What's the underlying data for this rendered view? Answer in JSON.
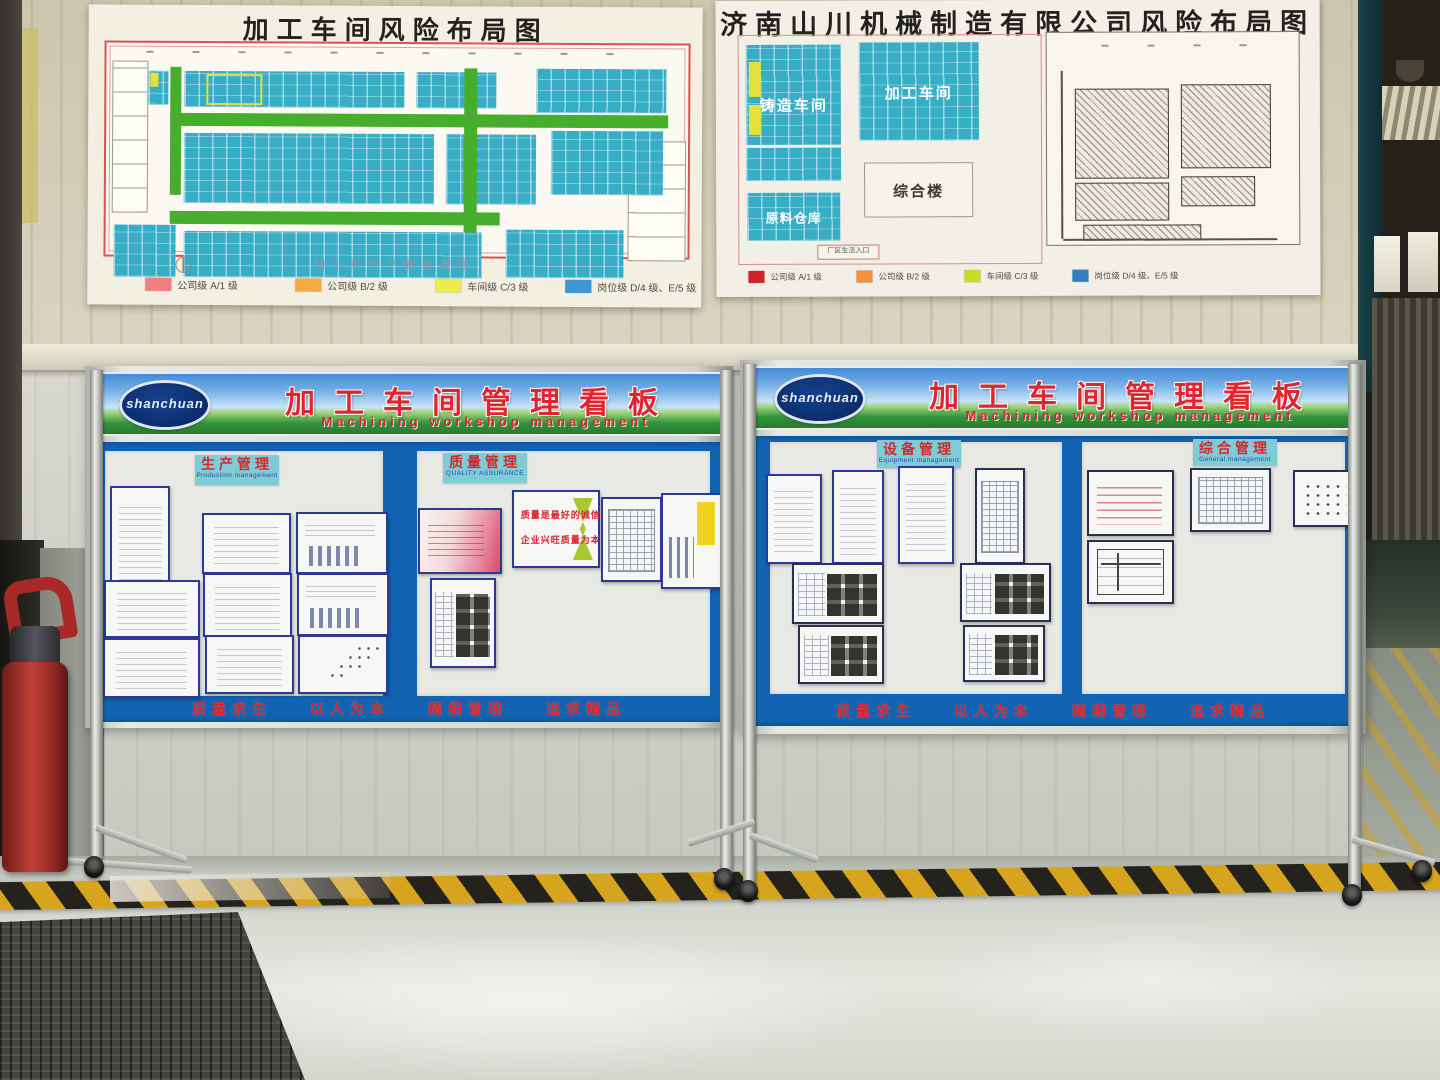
{
  "posters": {
    "left": {
      "title": "加工车间风险布局图",
      "caption": "加工车间平面布置图",
      "legend": [
        {
          "color": "#f08080",
          "label": "公司级  A/1 级"
        },
        {
          "color": "#f5a93f",
          "label": "公司级  B/2 级"
        },
        {
          "color": "#efed4d",
          "label": "车间级  C/3 级"
        },
        {
          "color": "#3f96d2",
          "label": "岗位级  D/4 级、E/5 级"
        }
      ]
    },
    "right": {
      "title": "济南山川机械制造有限公司风险布局图",
      "blocks": {
        "casting": "铸造车间",
        "machining": "加工车间",
        "office": "综合楼",
        "warehouse": "原料仓库",
        "entrance": "厂区生活入口"
      },
      "legend": [
        {
          "color": "#d2232a",
          "label": "公司级 A/1 级"
        },
        {
          "color": "#f0923f",
          "label": "公司级 B/2 级"
        },
        {
          "color": "#cbdb2a",
          "label": "车间级 C/3 级"
        },
        {
          "color": "#2f7fc1",
          "label": "岗位级 D/4 级、E/5 级"
        }
      ]
    }
  },
  "boards": {
    "banner_title_cn": "加工车间管理看板",
    "banner_title_en": "Machining workshop management",
    "logo_text": "shanchuan",
    "slogan": [
      "质量求生",
      "以人为本",
      "精细管理",
      "追求精品"
    ],
    "left_panels": [
      {
        "label_cn": "生产管理",
        "label_en": "Production management"
      },
      {
        "label_cn": "质量管理",
        "label_en": "QUALITY ASSURANCE"
      }
    ],
    "right_panels": [
      {
        "label_cn": "设备管理",
        "label_en": "Equipment management"
      },
      {
        "label_cn": "综合管理",
        "label_en": "General management"
      }
    ],
    "quality_slogans": [
      "质量是最好的诚信",
      "企业兴旺质量为本"
    ]
  }
}
